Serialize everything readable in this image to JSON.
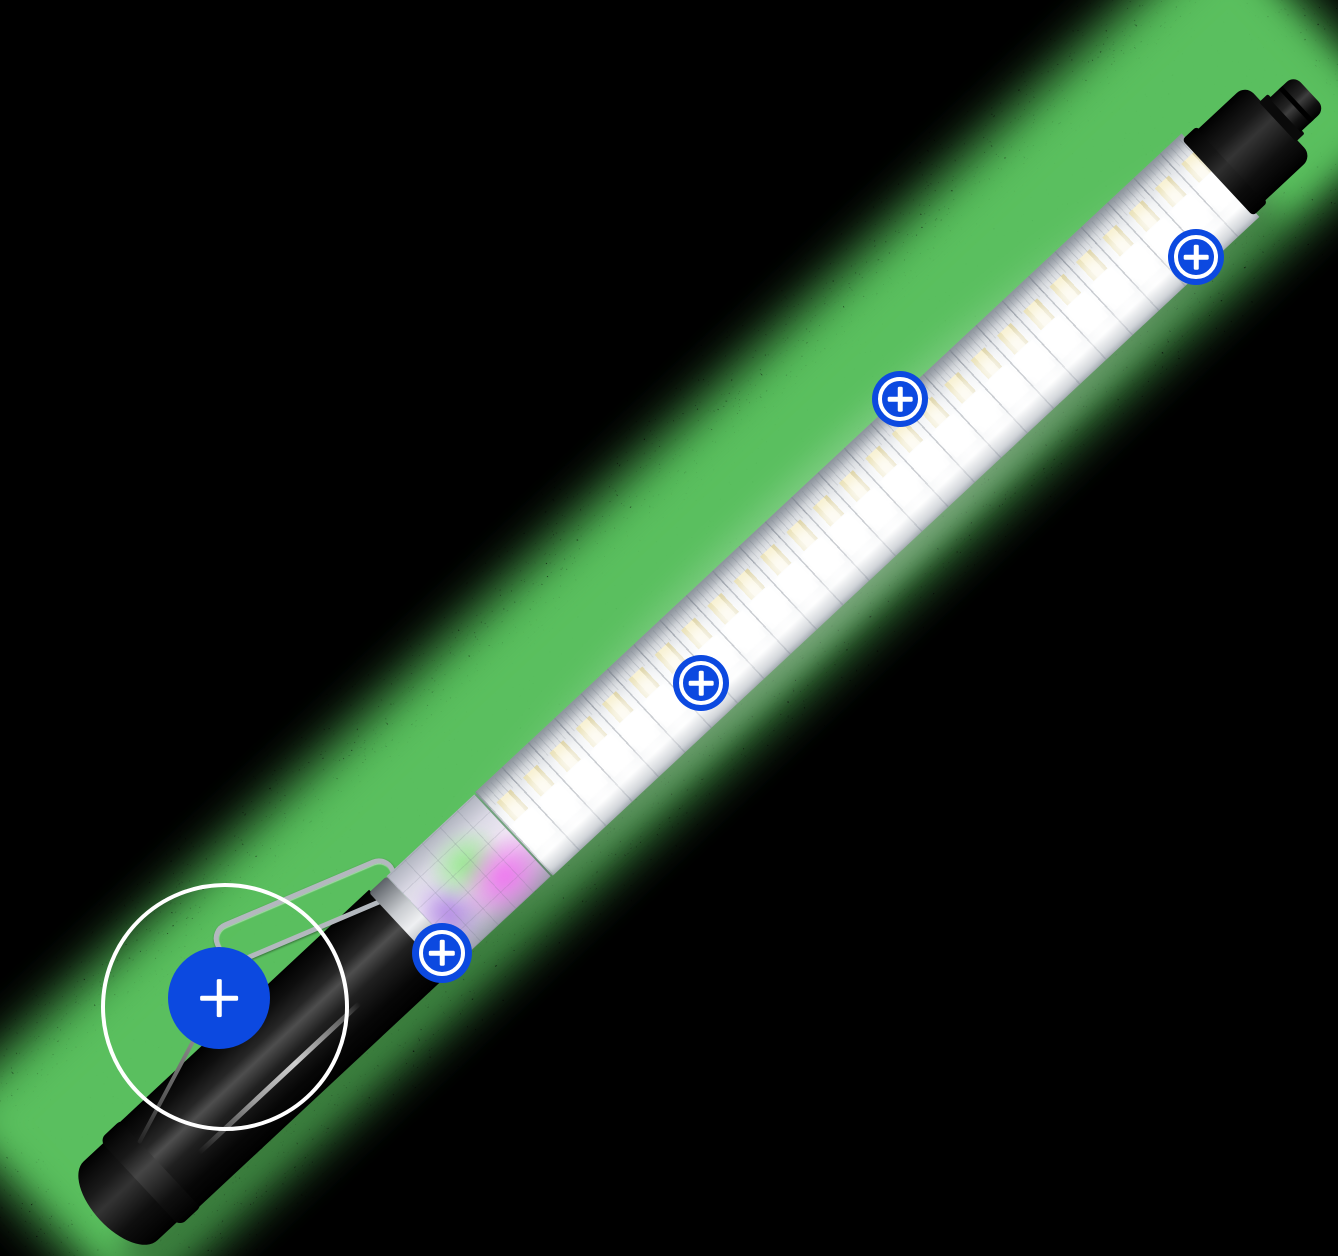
{
  "canvas": {
    "width": 1338,
    "height": 1256,
    "background": "#000000"
  },
  "spray": {
    "color": "#4fb254",
    "core_color": "#5abf5e"
  },
  "hotspots": {
    "color": "#0c49e0",
    "icon": "plus-icon",
    "glyph": "+",
    "items": [
      {
        "id": "hotspot-tip-connector",
        "x": 1196,
        "y": 257,
        "size": 56,
        "variant": "ring"
      },
      {
        "id": "hotspot-led-strip-upper",
        "x": 900,
        "y": 399,
        "size": 56,
        "variant": "ring"
      },
      {
        "id": "hotspot-led-strip-middle",
        "x": 701,
        "y": 683,
        "size": 56,
        "variant": "ring"
      },
      {
        "id": "hotspot-color-diffuser",
        "x": 442,
        "y": 953,
        "size": 60,
        "variant": "ring"
      },
      {
        "id": "hotspot-handle",
        "x": 219,
        "y": 998,
        "size": 102,
        "variant": "solid"
      }
    ]
  },
  "focus_ring": {
    "x": 221,
    "y": 1003,
    "radius": 120,
    "stroke_color": "#ffffff",
    "stroke_width": 4
  }
}
